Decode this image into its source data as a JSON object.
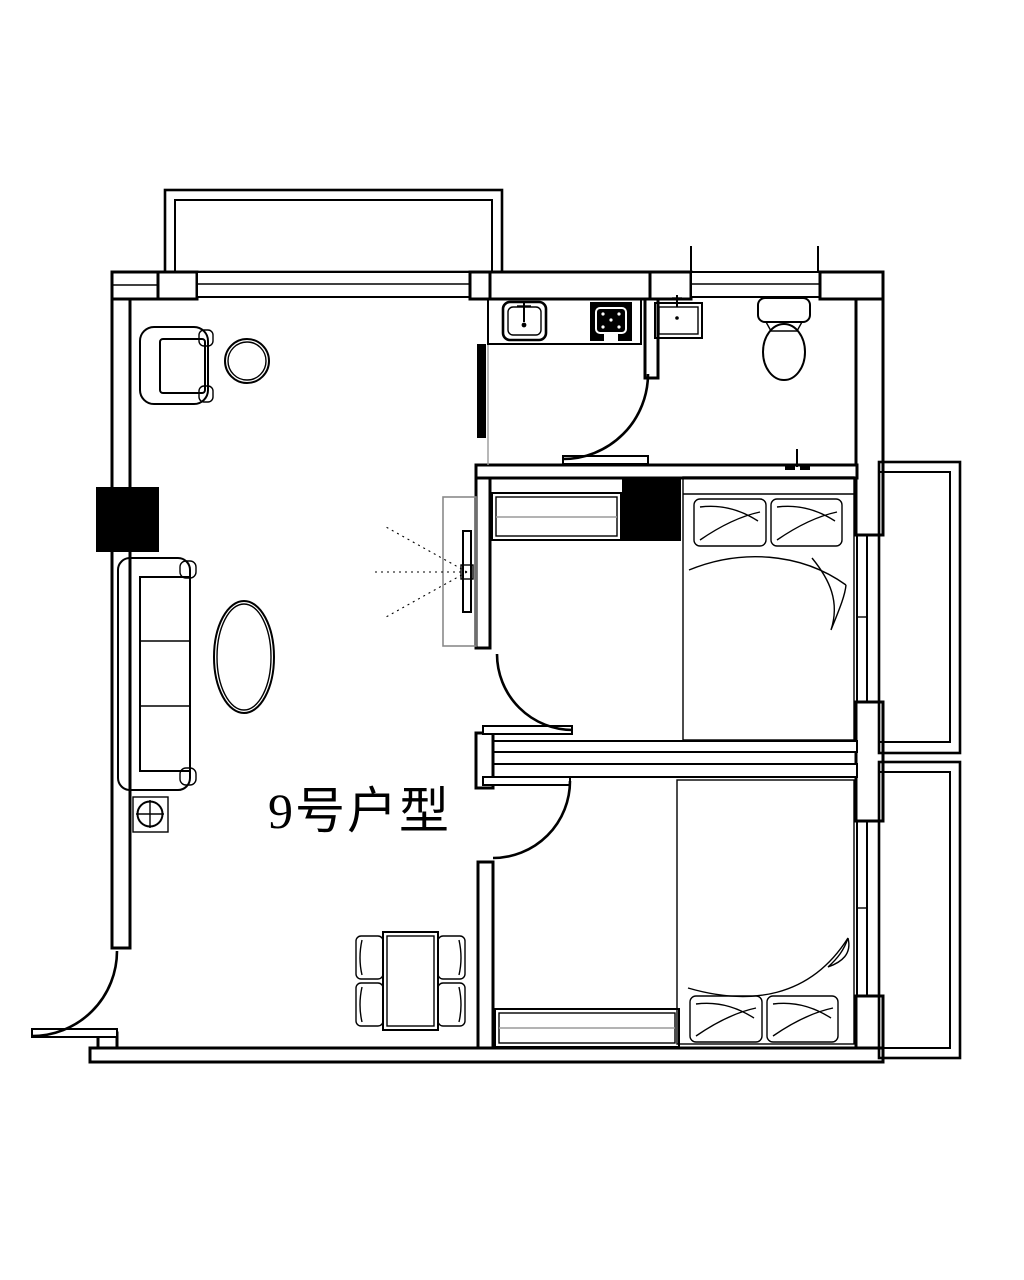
{
  "drawing": {
    "title": "9号户型",
    "title_font_px": 50,
    "ink_color": "#000000",
    "paper_color": "#ffffff",
    "helper_gray": "#9a9a9a",
    "symbols": [
      "bay-window",
      "entry-door-arc",
      "bathroom-door-arc",
      "bedroom1-door-arc",
      "bedroom2-door-arc",
      "sliding-kitchen-door",
      "structural-column-left",
      "structural-column-middle",
      "kitchen-sink",
      "kitchen-stove",
      "wash-basin",
      "toilet",
      "shower-drain",
      "armchair",
      "round-side-table",
      "sofa",
      "floor-lamp",
      "coffee-table",
      "tv-cabinet",
      "tv-sight-lines",
      "wardrobe-bedroom1",
      "wardrobe-bedroom2",
      "double-bed-1",
      "double-bed-2",
      "dining-table-4-chairs",
      "balcony-upper",
      "balcony-lower",
      "window-top-left",
      "window-bathroom",
      "window-bedroom1",
      "window-bedroom2"
    ]
  }
}
